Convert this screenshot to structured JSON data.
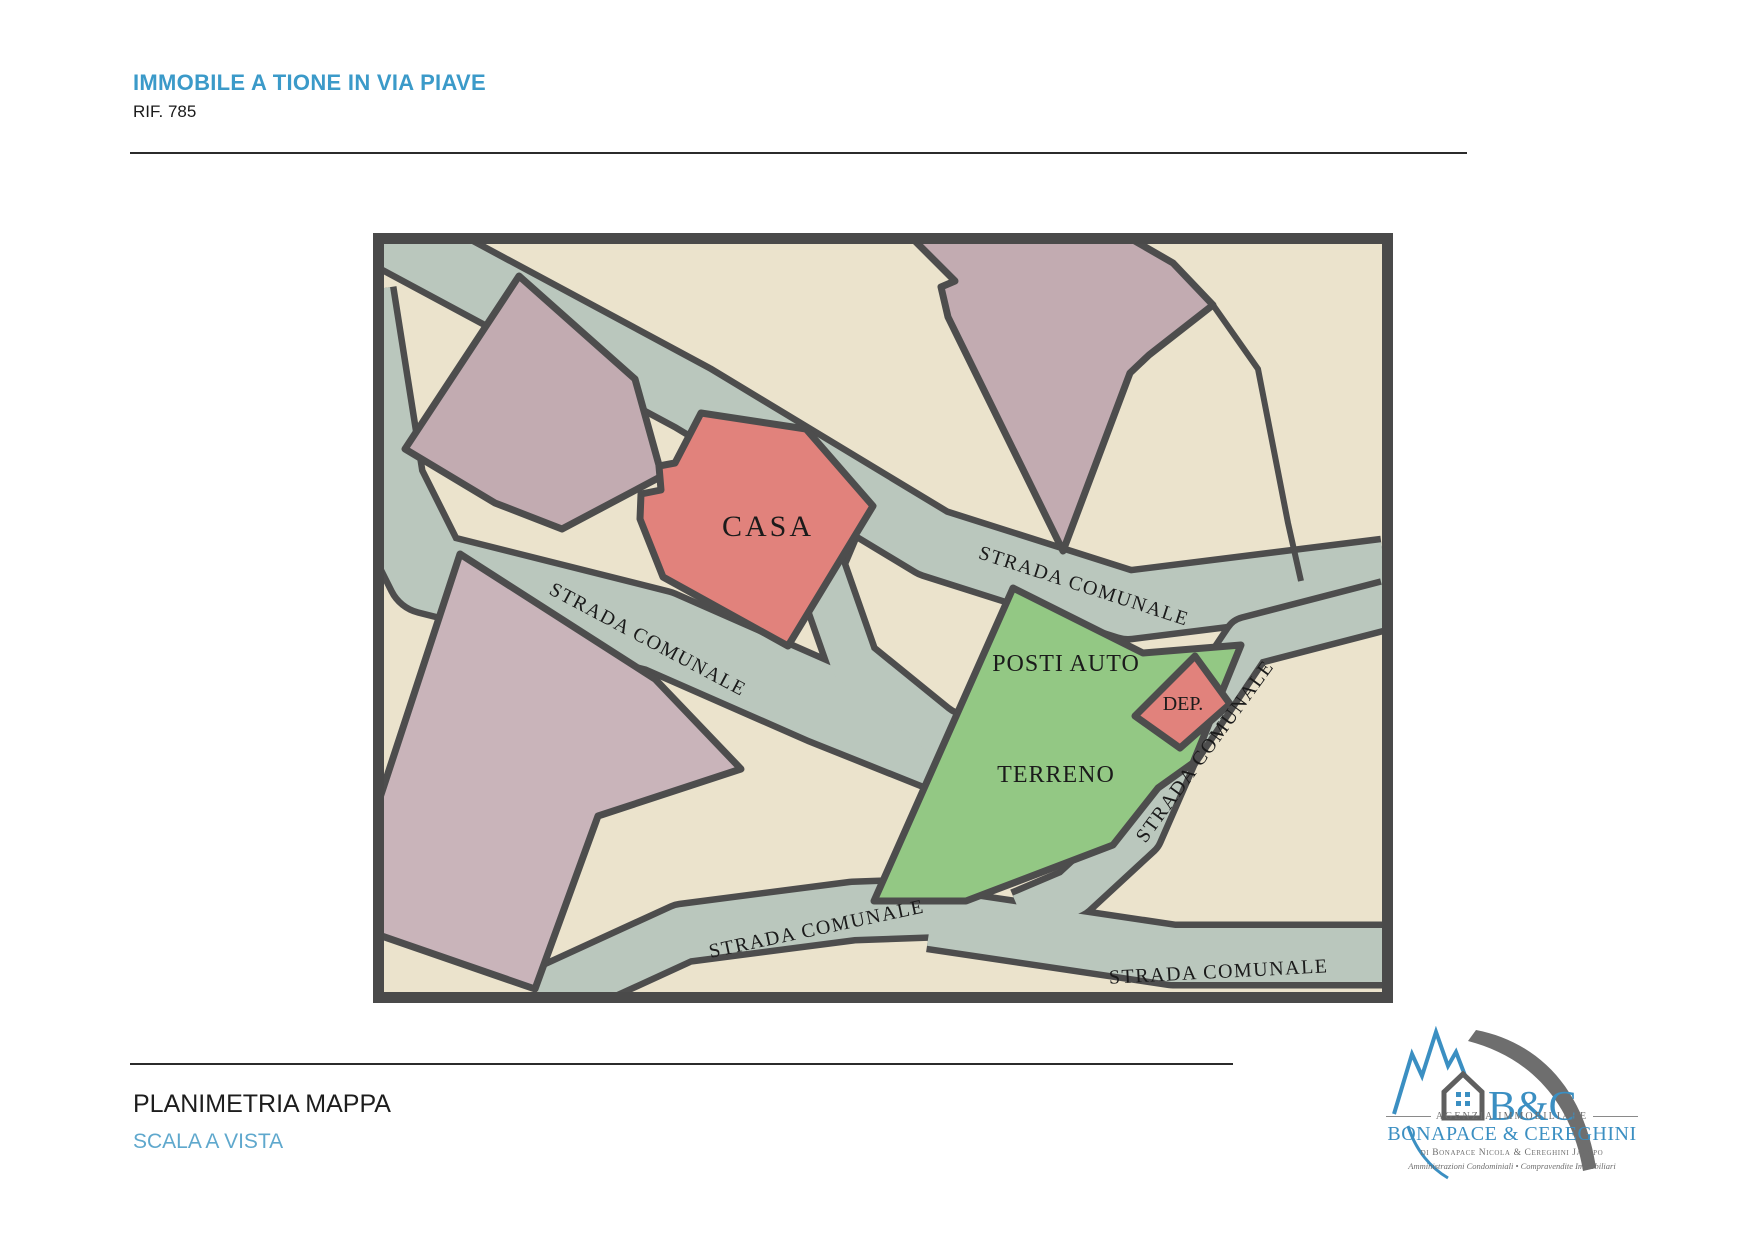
{
  "header": {
    "title": "IMMOBILE A TIONE IN VIA PIAVE",
    "reference": "RIF. 785",
    "title_color": "#3b9ac9"
  },
  "map": {
    "labels": {
      "casa": "CASA",
      "posti_auto": "POSTI AUTO",
      "terreno": "TERRENO",
      "dep": "DEP.",
      "road": "STRADA COMUNALE"
    },
    "colors": {
      "road": "#bac7bd",
      "parcel": "#ebe3cc",
      "building": "#c2abb1",
      "parcel_building": "#c9b4ba",
      "subject_building": "#e1827c",
      "land": "#93c884",
      "border": "#4d4d4d",
      "frame": "#4a4a4a"
    }
  },
  "footer": {
    "caption": "PLANIMETRIA MAPPA",
    "scale_note": "SCALA A VISTA",
    "scale_color": "#5fa8cd"
  },
  "logo": {
    "brand": "B&C",
    "tagline": "AGENZIA IMMOBILIARE",
    "company": "BONAPACE & CEREGHINI",
    "owners": "di Bonapace Nicola & Cereghini Jacopo",
    "services": "Amministrazioni Condominiali • Compravendite Immobiliari"
  }
}
